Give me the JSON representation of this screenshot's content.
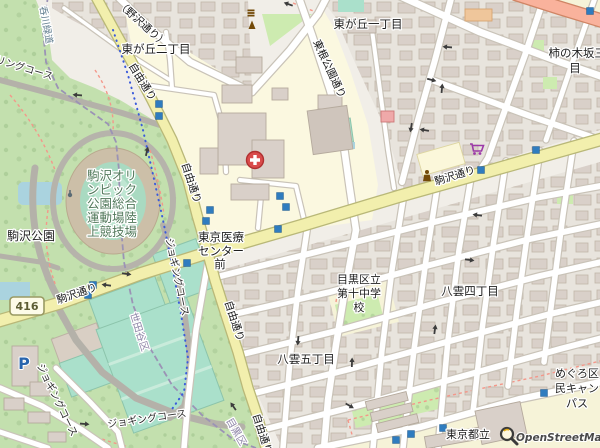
{
  "map": {
    "attribution": {
      "text": "OpenStreetMap"
    },
    "route_shield": {
      "text": "416"
    },
    "parking_label": "P",
    "labels": {
      "higashigaoka2": "東が丘二丁目",
      "higashigaoka1": "東が丘一丁目",
      "kakinokizaka_line1": "柿の木坂三丁",
      "kakinokizaka_line2": "目",
      "komazawa_park": "駒沢公園",
      "stadium_lines": [
        "駒沢オリ",
        "ンピック",
        "公園総合",
        "運動場陸",
        "上競技場"
      ],
      "iryo_lines": [
        "東京医療",
        "センター",
        "前"
      ],
      "meguro10_lines": [
        "目黒区立",
        "第十中学",
        "校"
      ],
      "yakumo5": "八雲五丁目",
      "yakumo4": "八雲四丁目",
      "campus_lines": [
        "めぐろ区",
        "民キャン",
        "パス"
      ],
      "tokyo_toritsu": "東京都立",
      "nozawa_dori": "（野沢通り）",
      "jiyu_dori": "自由通り",
      "komazawa_dori": "駒沢通り",
      "tokon_koen_dori": "東根公園通り",
      "cycling_course": "サイクリングコース",
      "jogging_course": "ジョギングコース",
      "nomigawa": "呑川緑道",
      "setagaya_ku": "世田谷区",
      "meguro_ku": "目黒区"
    },
    "markers": {
      "bus_stops": [
        [
          159,
          104
        ],
        [
          159,
          116
        ],
        [
          280,
          196
        ],
        [
          286,
          207
        ],
        [
          210,
          210
        ],
        [
          206,
          221
        ],
        [
          278,
          229
        ],
        [
          187,
          263
        ],
        [
          93,
          285
        ],
        [
          88,
          295
        ],
        [
          536,
          150
        ],
        [
          481,
          170
        ],
        [
          544,
          393
        ],
        [
          443,
          428
        ],
        [
          411,
          434
        ],
        [
          396,
          440
        ],
        [
          590,
          11
        ]
      ],
      "oneway_arrows": [
        [
          288,
          4,
          200
        ],
        [
          447,
          47,
          185
        ],
        [
          432,
          80,
          15
        ],
        [
          442,
          88,
          275
        ],
        [
          411,
          128,
          100
        ],
        [
          424,
          130,
          190
        ],
        [
          147,
          151,
          283
        ],
        [
          77,
          95,
          185
        ],
        [
          127,
          274,
          8
        ],
        [
          106,
          285,
          188
        ],
        [
          298,
          341,
          95
        ],
        [
          233,
          406,
          235
        ],
        [
          85,
          424,
          5
        ],
        [
          352,
          362,
          272
        ],
        [
          350,
          406,
          30
        ],
        [
          477,
          215,
          188
        ],
        [
          470,
          260,
          8
        ],
        [
          435,
          329,
          278
        ]
      ]
    },
    "colors": {
      "road_secondary": "#f2efad",
      "road_trunk": "#f9b29c",
      "water": "#aad3df",
      "pitch": "#aae0cb",
      "park": "#c3e0ae",
      "grass": "#cdebb0",
      "building": "#d9d0c9",
      "hospital_icon": "#d94b4b",
      "supermarket_icon": "#9c39a8",
      "bus_stop": "#2f7cbf",
      "historic_icon": "#734a08"
    }
  }
}
